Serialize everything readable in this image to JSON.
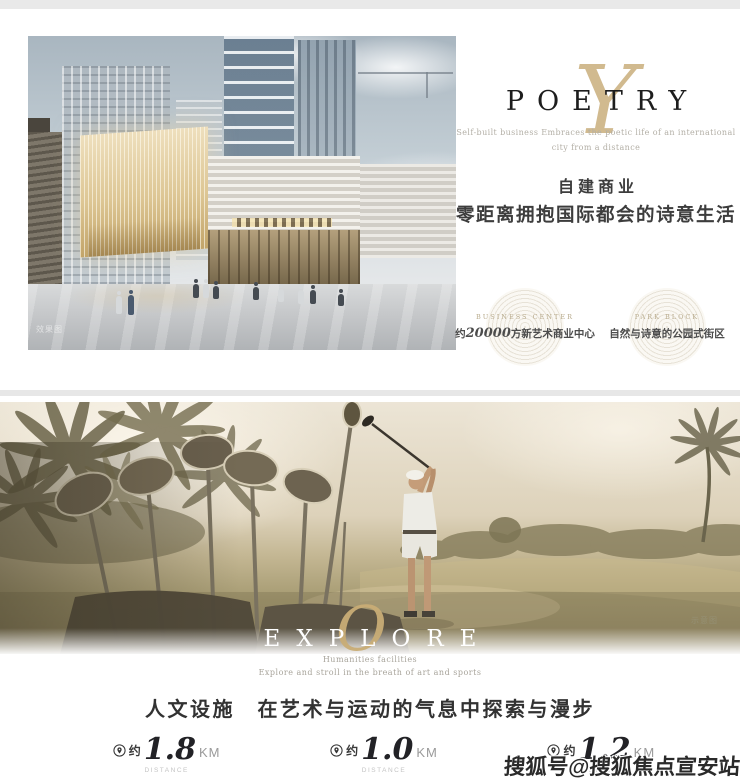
{
  "poetry_section": {
    "script_letter": "Y",
    "title": "POETRY",
    "tagline_line1": "Self-built business Embraces the poetic life of an international",
    "tagline_line2": "city from a distance",
    "headline_line1": "自建商业",
    "headline_line2": "零距离拥抱国际都会的诗意生活",
    "render_caption": "效果图",
    "badges": [
      {
        "title_en": "BUSINESS CENTER",
        "text_prefix": "约",
        "number": "20000",
        "text_suffix": "方新艺术商业中心"
      },
      {
        "title_en": "PARK BLOCK",
        "text": "自然与诗意的公园式街区"
      }
    ]
  },
  "explore_section": {
    "script_letter": "O",
    "title": "EXPLORE",
    "photo_caption": "示意图",
    "sub_en_line1": "Humanities facilities",
    "sub_en_line2": "Explore and stroll in the breath of art and sports",
    "headline": "人文设施　在艺术与运动的气息中探索与漫步",
    "distances": [
      {
        "approx": "约",
        "value": "1.8",
        "unit": "KM",
        "label": "DISTANCE",
        "desc": "艺术+生活 上海国际舞蹈中心"
      },
      {
        "approx": "约",
        "value": "1.0",
        "unit": "KM",
        "label": "DISTANCE",
        "desc": "运动+生活 虹桥高尔夫俱乐部"
      },
      {
        "approx": "约",
        "value": "1.2",
        "unit": "KM",
        "label": "DISTANCE",
        "desc": "探索+生活 上海蟠龙天地"
      }
    ]
  },
  "watermark": "搜狐号@搜狐焦点宣安站",
  "colors": {
    "gold": "#c9ae7c",
    "title_dark": "#1d1d1d",
    "tagline_gray": "#b3afa6",
    "cn_dark": "#3d3d3d"
  }
}
